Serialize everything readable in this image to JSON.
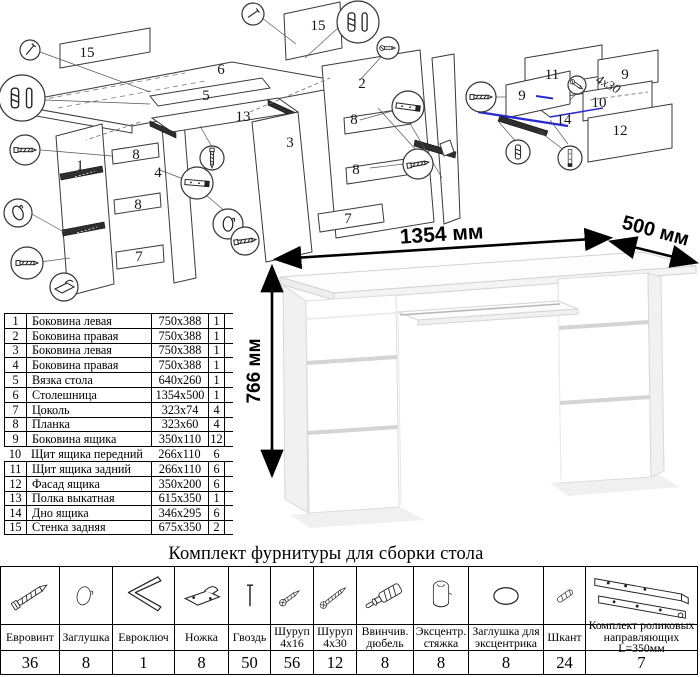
{
  "desk": {
    "dim_width": "1354 мм",
    "dim_depth": "500 мм",
    "dim_height": "766 мм"
  },
  "diagram_main": {
    "labels": [
      {
        "t": "15",
        "x": 87,
        "y": 57
      },
      {
        "t": "6",
        "x": 221,
        "y": 74
      },
      {
        "t": "15",
        "x": 318,
        "y": 30
      },
      {
        "t": "2",
        "x": 362,
        "y": 88
      },
      {
        "t": "5",
        "x": 206,
        "y": 100
      },
      {
        "t": "13",
        "x": 243,
        "y": 121
      },
      {
        "t": "3",
        "x": 290,
        "y": 147
      },
      {
        "t": "8",
        "x": 354,
        "y": 124
      },
      {
        "t": "8",
        "x": 356,
        "y": 174
      },
      {
        "t": "7",
        "x": 348,
        "y": 223
      },
      {
        "t": "1",
        "x": 80,
        "y": 170
      },
      {
        "t": "8",
        "x": 136,
        "y": 159
      },
      {
        "t": "4",
        "x": 158,
        "y": 177
      },
      {
        "t": "8",
        "x": 138,
        "y": 209
      },
      {
        "t": "7",
        "x": 139,
        "y": 261
      }
    ]
  },
  "diagram_drawer": {
    "screw_note": "4x30",
    "labels": [
      {
        "t": "11",
        "x": 112,
        "y": 39
      },
      {
        "t": "9",
        "x": 82,
        "y": 60
      },
      {
        "t": "9",
        "x": 185,
        "y": 39
      },
      {
        "t": "10",
        "x": 159,
        "y": 67
      },
      {
        "t": "12",
        "x": 180,
        "y": 95
      },
      {
        "t": "14",
        "x": 124,
        "y": 84
      }
    ]
  },
  "parts_table": {
    "rows": [
      {
        "num": "1",
        "name": "Боковина левая",
        "size": "750x388",
        "qty": "1"
      },
      {
        "num": "2",
        "name": "Боковина правая",
        "size": "750x388",
        "qty": "1"
      },
      {
        "num": "3",
        "name": "Боковина левая",
        "size": "750x388",
        "qty": "1"
      },
      {
        "num": "4",
        "name": "Боковина правая",
        "size": "750x388",
        "qty": "1"
      },
      {
        "num": "5",
        "name": "Вязка стола",
        "size": "640x260",
        "qty": "1"
      },
      {
        "num": "6",
        "name": "Столешница",
        "size": "1354x500",
        "qty": "1"
      },
      {
        "num": "7",
        "name": "Цоколь",
        "size": "323x74",
        "qty": "4"
      },
      {
        "num": "8",
        "name": "Планка",
        "size": "323x60",
        "qty": "4"
      },
      {
        "num": "9",
        "name": "Боковина ящика",
        "size": "350x110",
        "qty": "12"
      },
      {
        "num": "10",
        "name": "Щит ящика передний",
        "size": "266x110",
        "qty": "6"
      },
      {
        "num": "11",
        "name": "Щит ящика задний",
        "size": "266x110",
        "qty": "6"
      },
      {
        "num": "12",
        "name": "Фасад ящика",
        "size": "350x200",
        "qty": "6"
      },
      {
        "num": "13",
        "name": "Полка выкатная",
        "size": "615x350",
        "qty": "1"
      },
      {
        "num": "14",
        "name": "Дно ящика",
        "size": "346x295",
        "qty": "6"
      },
      {
        "num": "15",
        "name": "Стенка задняя",
        "size": "675x350",
        "qty": "2"
      }
    ]
  },
  "hardware": {
    "title": "Комплект фурнитуры для сборки стола",
    "items": [
      {
        "icon": "confirmat-screw-icon",
        "name": "Евровинт",
        "qty": "36"
      },
      {
        "icon": "cap-icon",
        "name": "Заглушка",
        "qty": "8"
      },
      {
        "icon": "hex-key-icon",
        "name": "Евроключ",
        "qty": "1"
      },
      {
        "icon": "foot-icon",
        "name": "Ножка",
        "qty": "8"
      },
      {
        "icon": "nail-icon",
        "name": "Гвоздь",
        "qty": "50"
      },
      {
        "icon": "screw-4x16-icon",
        "name": "Шуруп 4x16",
        "qty": "56"
      },
      {
        "icon": "screw-4x30-icon",
        "name": "Шуруп 4x30",
        "qty": "12"
      },
      {
        "icon": "screw-in-dowel-icon",
        "name": "Ввинчив. дюбель",
        "qty": "8"
      },
      {
        "icon": "cam-lock-icon",
        "name": "Эксцентр. стяжка",
        "qty": "8"
      },
      {
        "icon": "cam-cap-icon",
        "name": "Заглушка для эксцентрика",
        "qty": "8"
      },
      {
        "icon": "wood-dowel-icon",
        "name": "Шкант",
        "qty": "24"
      },
      {
        "icon": "roller-slides-icon",
        "name": "Комплект роликовых направляющих L=350мм",
        "qty": "7"
      }
    ]
  }
}
